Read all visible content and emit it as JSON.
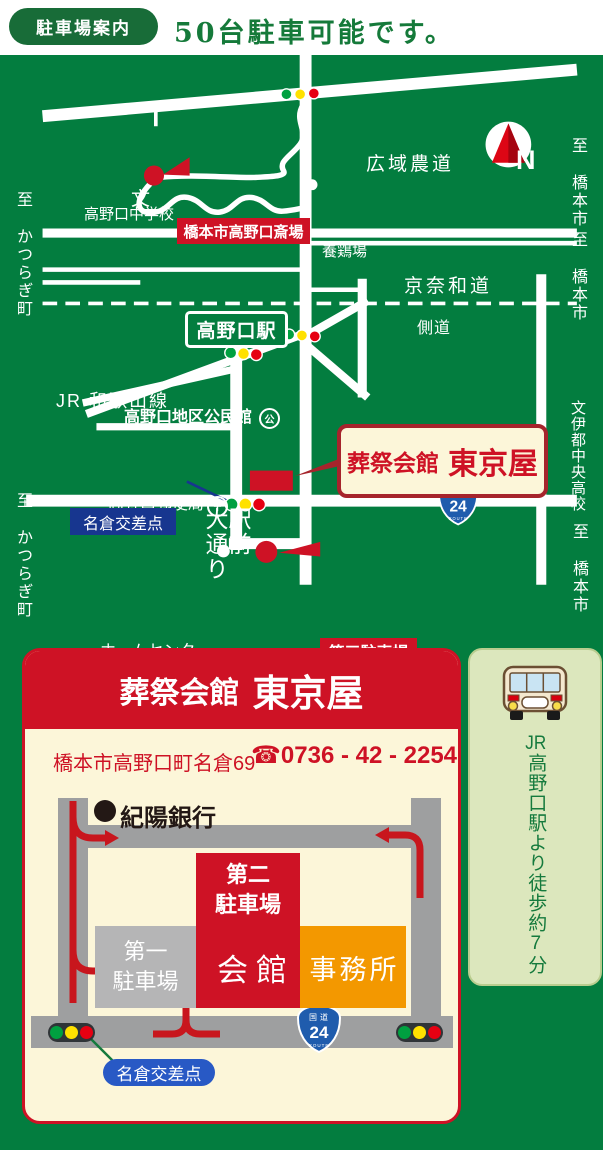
{
  "header": {
    "badge": "駐車場案内",
    "title": "50台駐車可能です。"
  },
  "map": {
    "labels": {
      "kouiki": "広域農道",
      "keinawa": "京奈和道",
      "sokudo": "側道",
      "jr_line": "JR 和歌山線",
      "ekimae_col1": "駅前",
      "ekimae_col2": "大通り",
      "katsuragi": "至 かつらぎ町",
      "hashimoto": "至 橋本市",
      "ito_school": "文伊都中央高校",
      "kudoyama": "至 九度山町",
      "compass": "N"
    },
    "pois": {
      "school_mark": "文",
      "junior_high": "高野口中学校",
      "saijo": "橋本市高野口斎場",
      "yokeijo": "養鶏場",
      "station": "高野口駅",
      "kominkan": "高野口地区公民館",
      "kominkan_mark": "公",
      "post_office": "高野口郵便局",
      "post_mark": "〒",
      "nagura": "名倉交差点",
      "daisan": "第三駐車場",
      "home_center": "ホームセンター"
    },
    "callout": {
      "name": "葬祭会館",
      "shop": "東京屋"
    },
    "route_badge": {
      "kanji": "国道",
      "number": "24",
      "word": "ROUTE"
    }
  },
  "card": {
    "title": {
      "name": "葬祭会館",
      "shop": "東京屋"
    },
    "address": "橋本市高野口町名倉69",
    "phone": "☎0736 - 42 - 2254",
    "map": {
      "bank": "紀陽銀行",
      "p2_line1": "第二",
      "p2_line2": "駐車場",
      "p1_line1": "第一",
      "p1_line2": "駐車場",
      "hall": "会館",
      "office": "事務所",
      "nagura": "名倉交差点"
    }
  },
  "sidebar": {
    "jr": "JR",
    "walk": "高野口駅より徒歩約7分"
  },
  "colors": {
    "map_green": "#037d3f",
    "brand_red": "#ce1225",
    "dark_red": "#a6242c",
    "cream": "#fcf6d9",
    "orange": "#f39800",
    "road_gray": "#9e9fa0",
    "parking_gray": "#b5b5b6",
    "navy": "#17368f",
    "pill_blue": "#2859c5",
    "route_blue": "#1f5cad",
    "signal_green": "#00a040",
    "signal_yellow": "#ffe100",
    "signal_red": "#e60012",
    "header_green": "#186c38",
    "text_green": "#157a3d",
    "sidebar_bg": "#dce7bd"
  }
}
